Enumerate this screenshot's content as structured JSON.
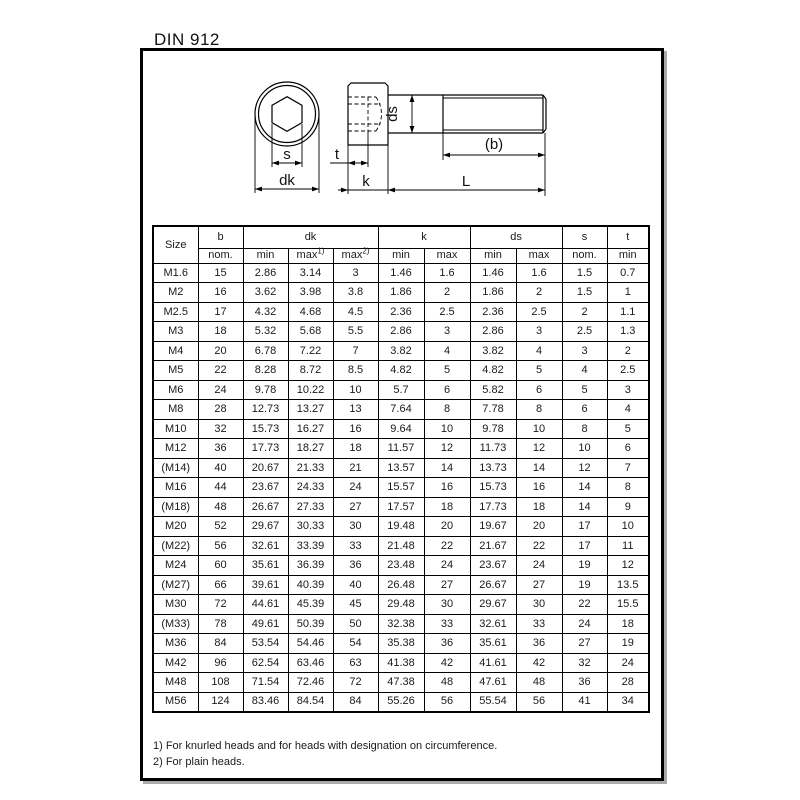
{
  "page": {
    "title": "DIN 912",
    "footnotes": [
      "1) For knurled heads and for heads with designation on circumference.",
      "2) For plain heads."
    ]
  },
  "colors": {
    "ink": "#1a1a1a",
    "line": "#000000",
    "frame_border": "#000000",
    "frame_shadow": "#aaaaaa",
    "background": "#ffffff"
  },
  "drawing": {
    "labels": {
      "s": "s",
      "dk": "dk",
      "t": "t",
      "k": "k",
      "ds": "ds",
      "b_paren": "(b)",
      "L": "L"
    }
  },
  "table": {
    "header": {
      "size": "Size",
      "b": "b",
      "dk": "dk",
      "k": "k",
      "ds": "ds",
      "s": "s",
      "t": "t",
      "nom": "nom.",
      "min": "min",
      "max": "max",
      "sup1": "1)",
      "sup2": "2)"
    },
    "rows": [
      [
        "M1.6",
        "15",
        "2.86",
        "3.14",
        "3",
        "1.46",
        "1.6",
        "1.46",
        "1.6",
        "1.5",
        "0.7"
      ],
      [
        "M2",
        "16",
        "3.62",
        "3.98",
        "3.8",
        "1.86",
        "2",
        "1.86",
        "2",
        "1.5",
        "1"
      ],
      [
        "M2.5",
        "17",
        "4.32",
        "4.68",
        "4.5",
        "2.36",
        "2.5",
        "2.36",
        "2.5",
        "2",
        "1.1"
      ],
      [
        "M3",
        "18",
        "5.32",
        "5.68",
        "5.5",
        "2.86",
        "3",
        "2.86",
        "3",
        "2.5",
        "1.3"
      ],
      [
        "M4",
        "20",
        "6.78",
        "7.22",
        "7",
        "3.82",
        "4",
        "3.82",
        "4",
        "3",
        "2"
      ],
      [
        "M5",
        "22",
        "8.28",
        "8.72",
        "8.5",
        "4.82",
        "5",
        "4.82",
        "5",
        "4",
        "2.5"
      ],
      [
        "M6",
        "24",
        "9.78",
        "10.22",
        "10",
        "5.7",
        "6",
        "5.82",
        "6",
        "5",
        "3"
      ],
      [
        "M8",
        "28",
        "12.73",
        "13.27",
        "13",
        "7.64",
        "8",
        "7.78",
        "8",
        "6",
        "4"
      ],
      [
        "M10",
        "32",
        "15.73",
        "16.27",
        "16",
        "9.64",
        "10",
        "9.78",
        "10",
        "8",
        "5"
      ],
      [
        "M12",
        "36",
        "17.73",
        "18.27",
        "18",
        "11.57",
        "12",
        "11.73",
        "12",
        "10",
        "6"
      ],
      [
        "(M14)",
        "40",
        "20.67",
        "21.33",
        "21",
        "13.57",
        "14",
        "13.73",
        "14",
        "12",
        "7"
      ],
      [
        "M16",
        "44",
        "23.67",
        "24.33",
        "24",
        "15.57",
        "16",
        "15.73",
        "16",
        "14",
        "8"
      ],
      [
        "(M18)",
        "48",
        "26.67",
        "27.33",
        "27",
        "17.57",
        "18",
        "17.73",
        "18",
        "14",
        "9"
      ],
      [
        "M20",
        "52",
        "29.67",
        "30.33",
        "30",
        "19.48",
        "20",
        "19.67",
        "20",
        "17",
        "10"
      ],
      [
        "(M22)",
        "56",
        "32.61",
        "33.39",
        "33",
        "21.48",
        "22",
        "21.67",
        "22",
        "17",
        "11"
      ],
      [
        "M24",
        "60",
        "35.61",
        "36.39",
        "36",
        "23.48",
        "24",
        "23.67",
        "24",
        "19",
        "12"
      ],
      [
        "(M27)",
        "66",
        "39.61",
        "40.39",
        "40",
        "26.48",
        "27",
        "26.67",
        "27",
        "19",
        "13.5"
      ],
      [
        "M30",
        "72",
        "44.61",
        "45.39",
        "45",
        "29.48",
        "30",
        "29.67",
        "30",
        "22",
        "15.5"
      ],
      [
        "(M33)",
        "78",
        "49.61",
        "50.39",
        "50",
        "32.38",
        "33",
        "32.61",
        "33",
        "24",
        "18"
      ],
      [
        "M36",
        "84",
        "53.54",
        "54.46",
        "54",
        "35.38",
        "36",
        "35.61",
        "36",
        "27",
        "19"
      ],
      [
        "M42",
        "96",
        "62.54",
        "63.46",
        "63",
        "41.38",
        "42",
        "41.61",
        "42",
        "32",
        "24"
      ],
      [
        "M48",
        "108",
        "71.54",
        "72.46",
        "72",
        "47.38",
        "48",
        "47.61",
        "48",
        "36",
        "28"
      ],
      [
        "M56",
        "124",
        "83.46",
        "84.54",
        "84",
        "55.26",
        "56",
        "55.54",
        "56",
        "41",
        "34"
      ]
    ]
  }
}
